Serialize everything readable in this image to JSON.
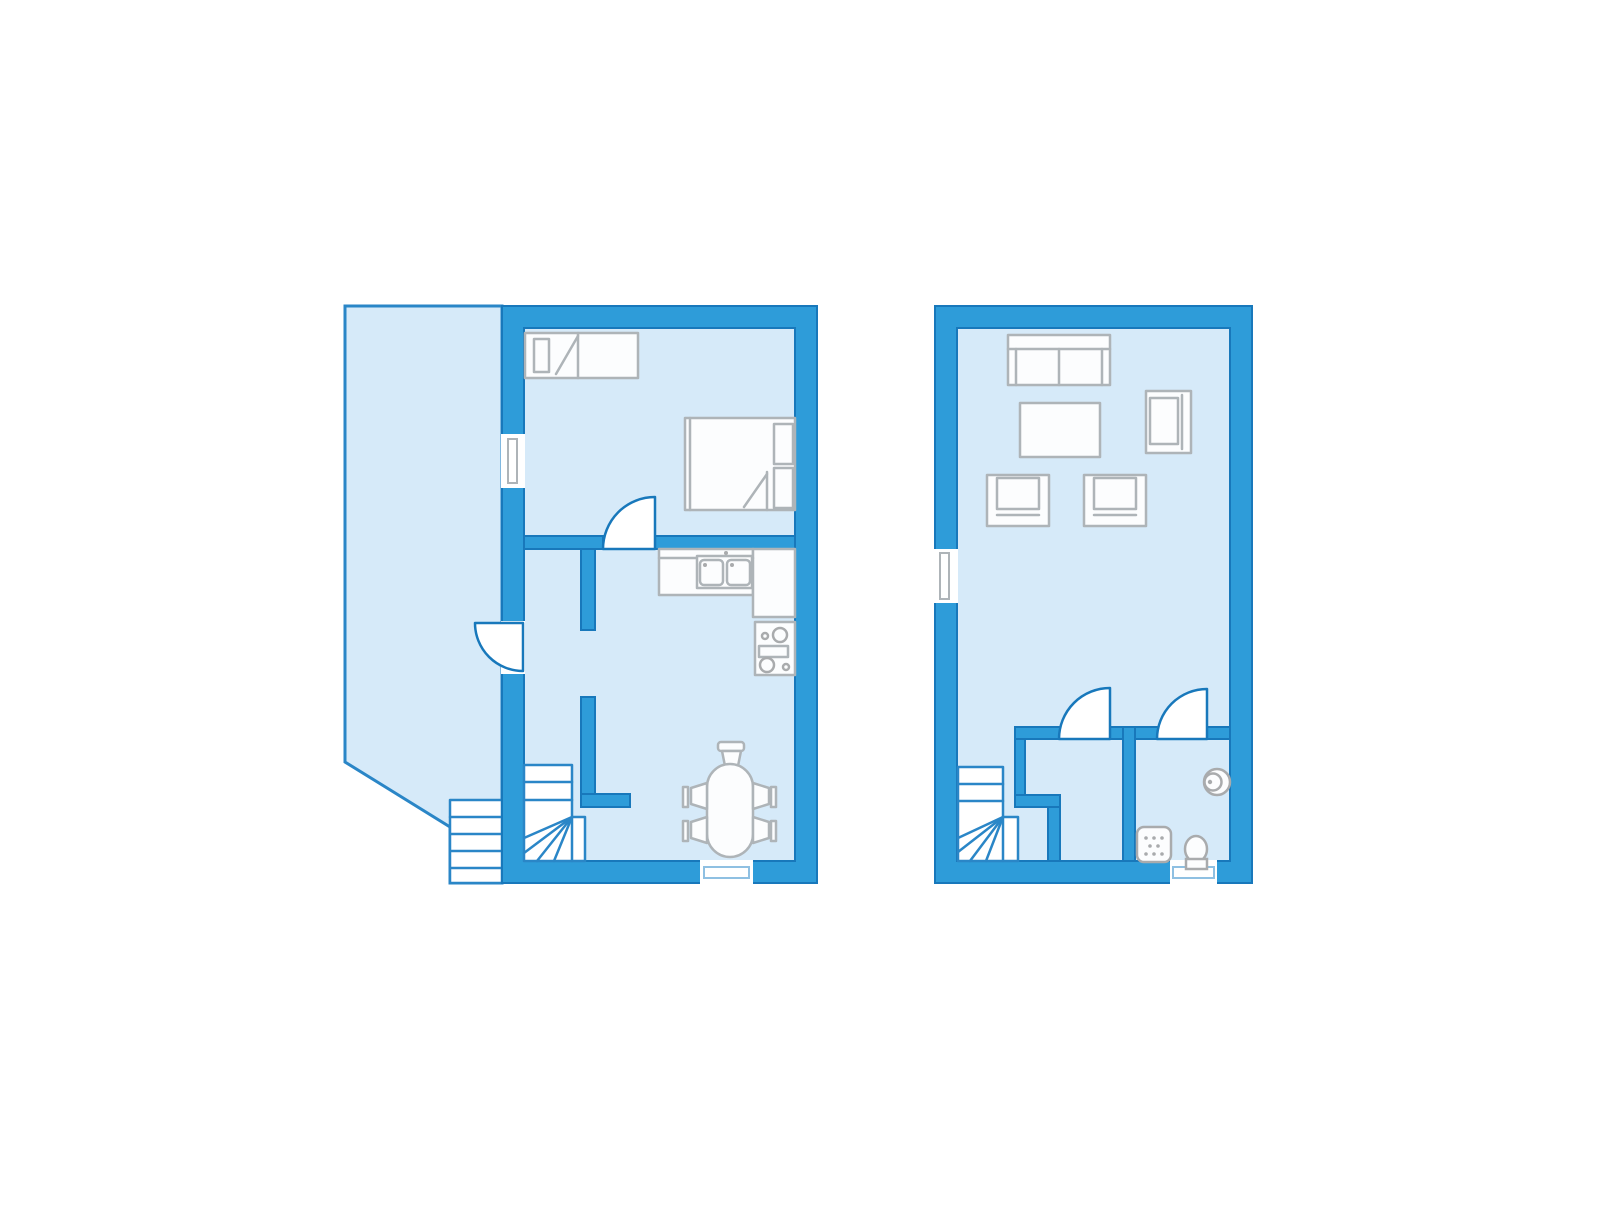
{
  "title": "Two-storey holiday house floor plan",
  "palette": {
    "background": "#ffffff",
    "wall_fill": "#2E9CD9",
    "wall_outline": "#1878BB",
    "floor_fill": "#D6EAF9",
    "door_fill": "#FFFFFF",
    "door_stroke": "#1878BB",
    "stair_stroke": "#2A86C7",
    "furniture_fill": "#FCFDFE",
    "furniture_stroke": "#AEB4B8",
    "fixture_stroke": "#A9ABAD",
    "threshold_stroke": "#8FC0E2"
  },
  "plans": [
    {
      "name": "ground-floor",
      "rooms": [
        "terrace",
        "bedroom",
        "hallway",
        "kitchen-dining-room"
      ],
      "symbols": [
        "single-bed",
        "double-bed",
        "kitchen-counter",
        "double-sink",
        "stove",
        "dining-table",
        "dining-chairs",
        "winder-staircase",
        "exterior-steps",
        "window",
        "terrace-door",
        "bedroom-door",
        "patio-threshold"
      ]
    },
    {
      "name": "upper-floor",
      "rooms": [
        "living-room",
        "closet",
        "bathroom"
      ],
      "symbols": [
        "sofa",
        "coffee-table",
        "armchair",
        "winder-staircase",
        "window",
        "closet-door",
        "bathroom-door",
        "shower",
        "toilet",
        "washbasin",
        "patio-threshold"
      ]
    }
  ]
}
